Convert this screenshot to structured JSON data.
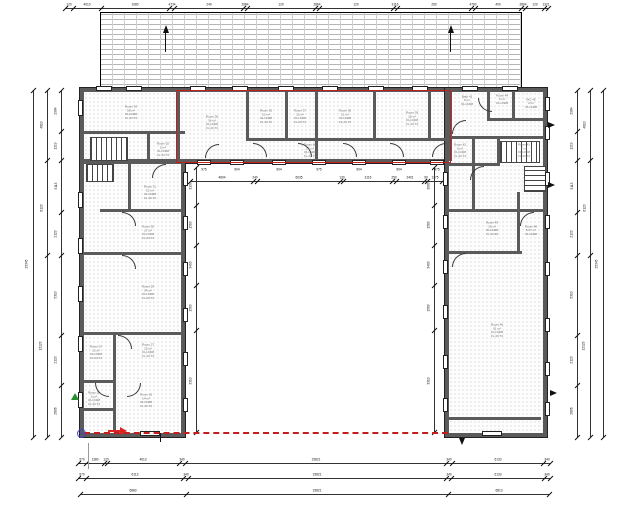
{
  "drawing": {
    "type": "architectural floor plan, ground storey, U-shaped building around courtyard",
    "highlight_color": "#c41d1d",
    "wall_color": "#5b5b5b",
    "dashed_boundary_color": "#c41d1d",
    "existing_building": "hatched brick block adjoining at top",
    "north_arrow_count": "2"
  },
  "rooms": [
    {
      "name": "Room 34",
      "area": "58 m²",
      "l3": "OH 2408",
      "l4": "FL 23.73"
    },
    {
      "name": "Room 02",
      "area": "5 m²",
      "l3": "OH 2408",
      "l4": "FL 23.73"
    },
    {
      "name": "Room 36",
      "area": "34 m²",
      "l3": "OH 2408",
      "l4": "FL 23.73"
    },
    {
      "name": "Room 35",
      "area": "21 m²",
      "l3": "OH 2408",
      "l4": "FL 23.73"
    },
    {
      "name": "Room 37",
      "area": "15 m²",
      "l3": "OH 2408",
      "l4": "FL 23.73"
    },
    {
      "name": "Room 38",
      "area": "21 m²",
      "l3": "OH 2408",
      "l4": "FL 23.73"
    },
    {
      "name": "Room 39",
      "area": "18 m²",
      "l3": "OH 2408",
      "l4": "FL 23.73"
    },
    {
      "name": "Room 40",
      "area": "14 m²",
      "l3": "OH 2408",
      "l4": "FL 23.73"
    },
    {
      "name": "Bath 43",
      "area": "8 m²",
      "l3": "OH 2408",
      "l4": ""
    },
    {
      "name": "Room 44",
      "area": "6 m²",
      "l3": "OH 2408",
      "l4": ""
    },
    {
      "name": "WC 45",
      "area": "3 m²",
      "l3": "OH 2408",
      "l4": ""
    },
    {
      "name": "Room 42",
      "area": "9 m²",
      "l3": "OH 2408",
      "l4": "FL 23.73"
    },
    {
      "name": "Room 41",
      "area": "7 m²",
      "l3": "OH 2408",
      "l4": "FL 23.73"
    },
    {
      "name": "Room 31",
      "area": "21 m²",
      "l3": "OH 2408",
      "l4": "FL 23.73"
    },
    {
      "name": "Room 30",
      "area": "17 m²",
      "l3": "OH 2408",
      "l4": "FL 23.73"
    },
    {
      "name": "Room 29",
      "area": "34 m²",
      "l3": "OH 2408",
      "l4": "FL 23.73"
    },
    {
      "name": "Room 07",
      "area": "13 m²",
      "l3": "OH 2408",
      "l4": "FL 23.73"
    },
    {
      "name": "Room 27",
      "area": "15 m²",
      "l3": "OH 2408",
      "l4": "FL 23.73"
    },
    {
      "name": "Room 06",
      "area": "5 m²",
      "l3": "OH 2408",
      "l4": "FL 23.73"
    },
    {
      "name": "Room 05",
      "area": "14 m²",
      "l3": "OH 2408",
      "l4": "FL 23.73"
    },
    {
      "name": "Room 49",
      "area": "30 m²",
      "l3": "OH 2408",
      "l4": "FL 23.68"
    },
    {
      "name": "Room 48",
      "area": "5.07 m²",
      "l3": "OH 2408",
      "l4": ""
    },
    {
      "name": "Room 46",
      "area": "91 m²",
      "l3": "OH 2408",
      "l4": "FL 23.73"
    }
  ],
  "dimensions": {
    "top": [
      "120",
      "4010",
      "1080",
      "4734",
      "240",
      "2984",
      "120",
      "2864",
      "120",
      "3116",
      "250",
      "4790",
      "400",
      "2804",
      "120",
      "1321"
    ],
    "courtyard_window_widths": [
      "975",
      "904",
      "904",
      "975",
      "904",
      "904",
      "975"
    ],
    "courtyard_top": [
      "4604",
      "240",
      "6035",
      "130",
      "3116",
      "250",
      "2401",
      "90",
      "1275"
    ],
    "courtyard_left": [
      "3133",
      "1563",
      "3403",
      "1563",
      "3310"
    ],
    "courtyard_right": [
      "3083",
      "1563",
      "3403",
      "1563",
      "3310"
    ],
    "left_inner": [
      "2984",
      "1219",
      "5113",
      "2123",
      "5310",
      "2123",
      "2806"
    ],
    "left_mid": [
      "4810",
      "6123",
      "12123"
    ],
    "left_outer": [
      "25345"
    ],
    "right_inner": [
      "2984",
      "1219",
      "5113",
      "2123",
      "5310",
      "2123",
      "2806"
    ],
    "right_mid": [
      "4810",
      "6123",
      "12123"
    ],
    "right_outer": [
      "25345"
    ],
    "bottom_row1": [
      "570",
      "1380",
      "120",
      "4613",
      "340",
      "15821",
      "340",
      "6133",
      "340"
    ],
    "bottom_row2": [
      "570",
      "6113",
      "340",
      "15821",
      "340",
      "6133",
      "340"
    ],
    "bottom_row3": [
      "6883",
      "15821",
      "6813"
    ]
  }
}
